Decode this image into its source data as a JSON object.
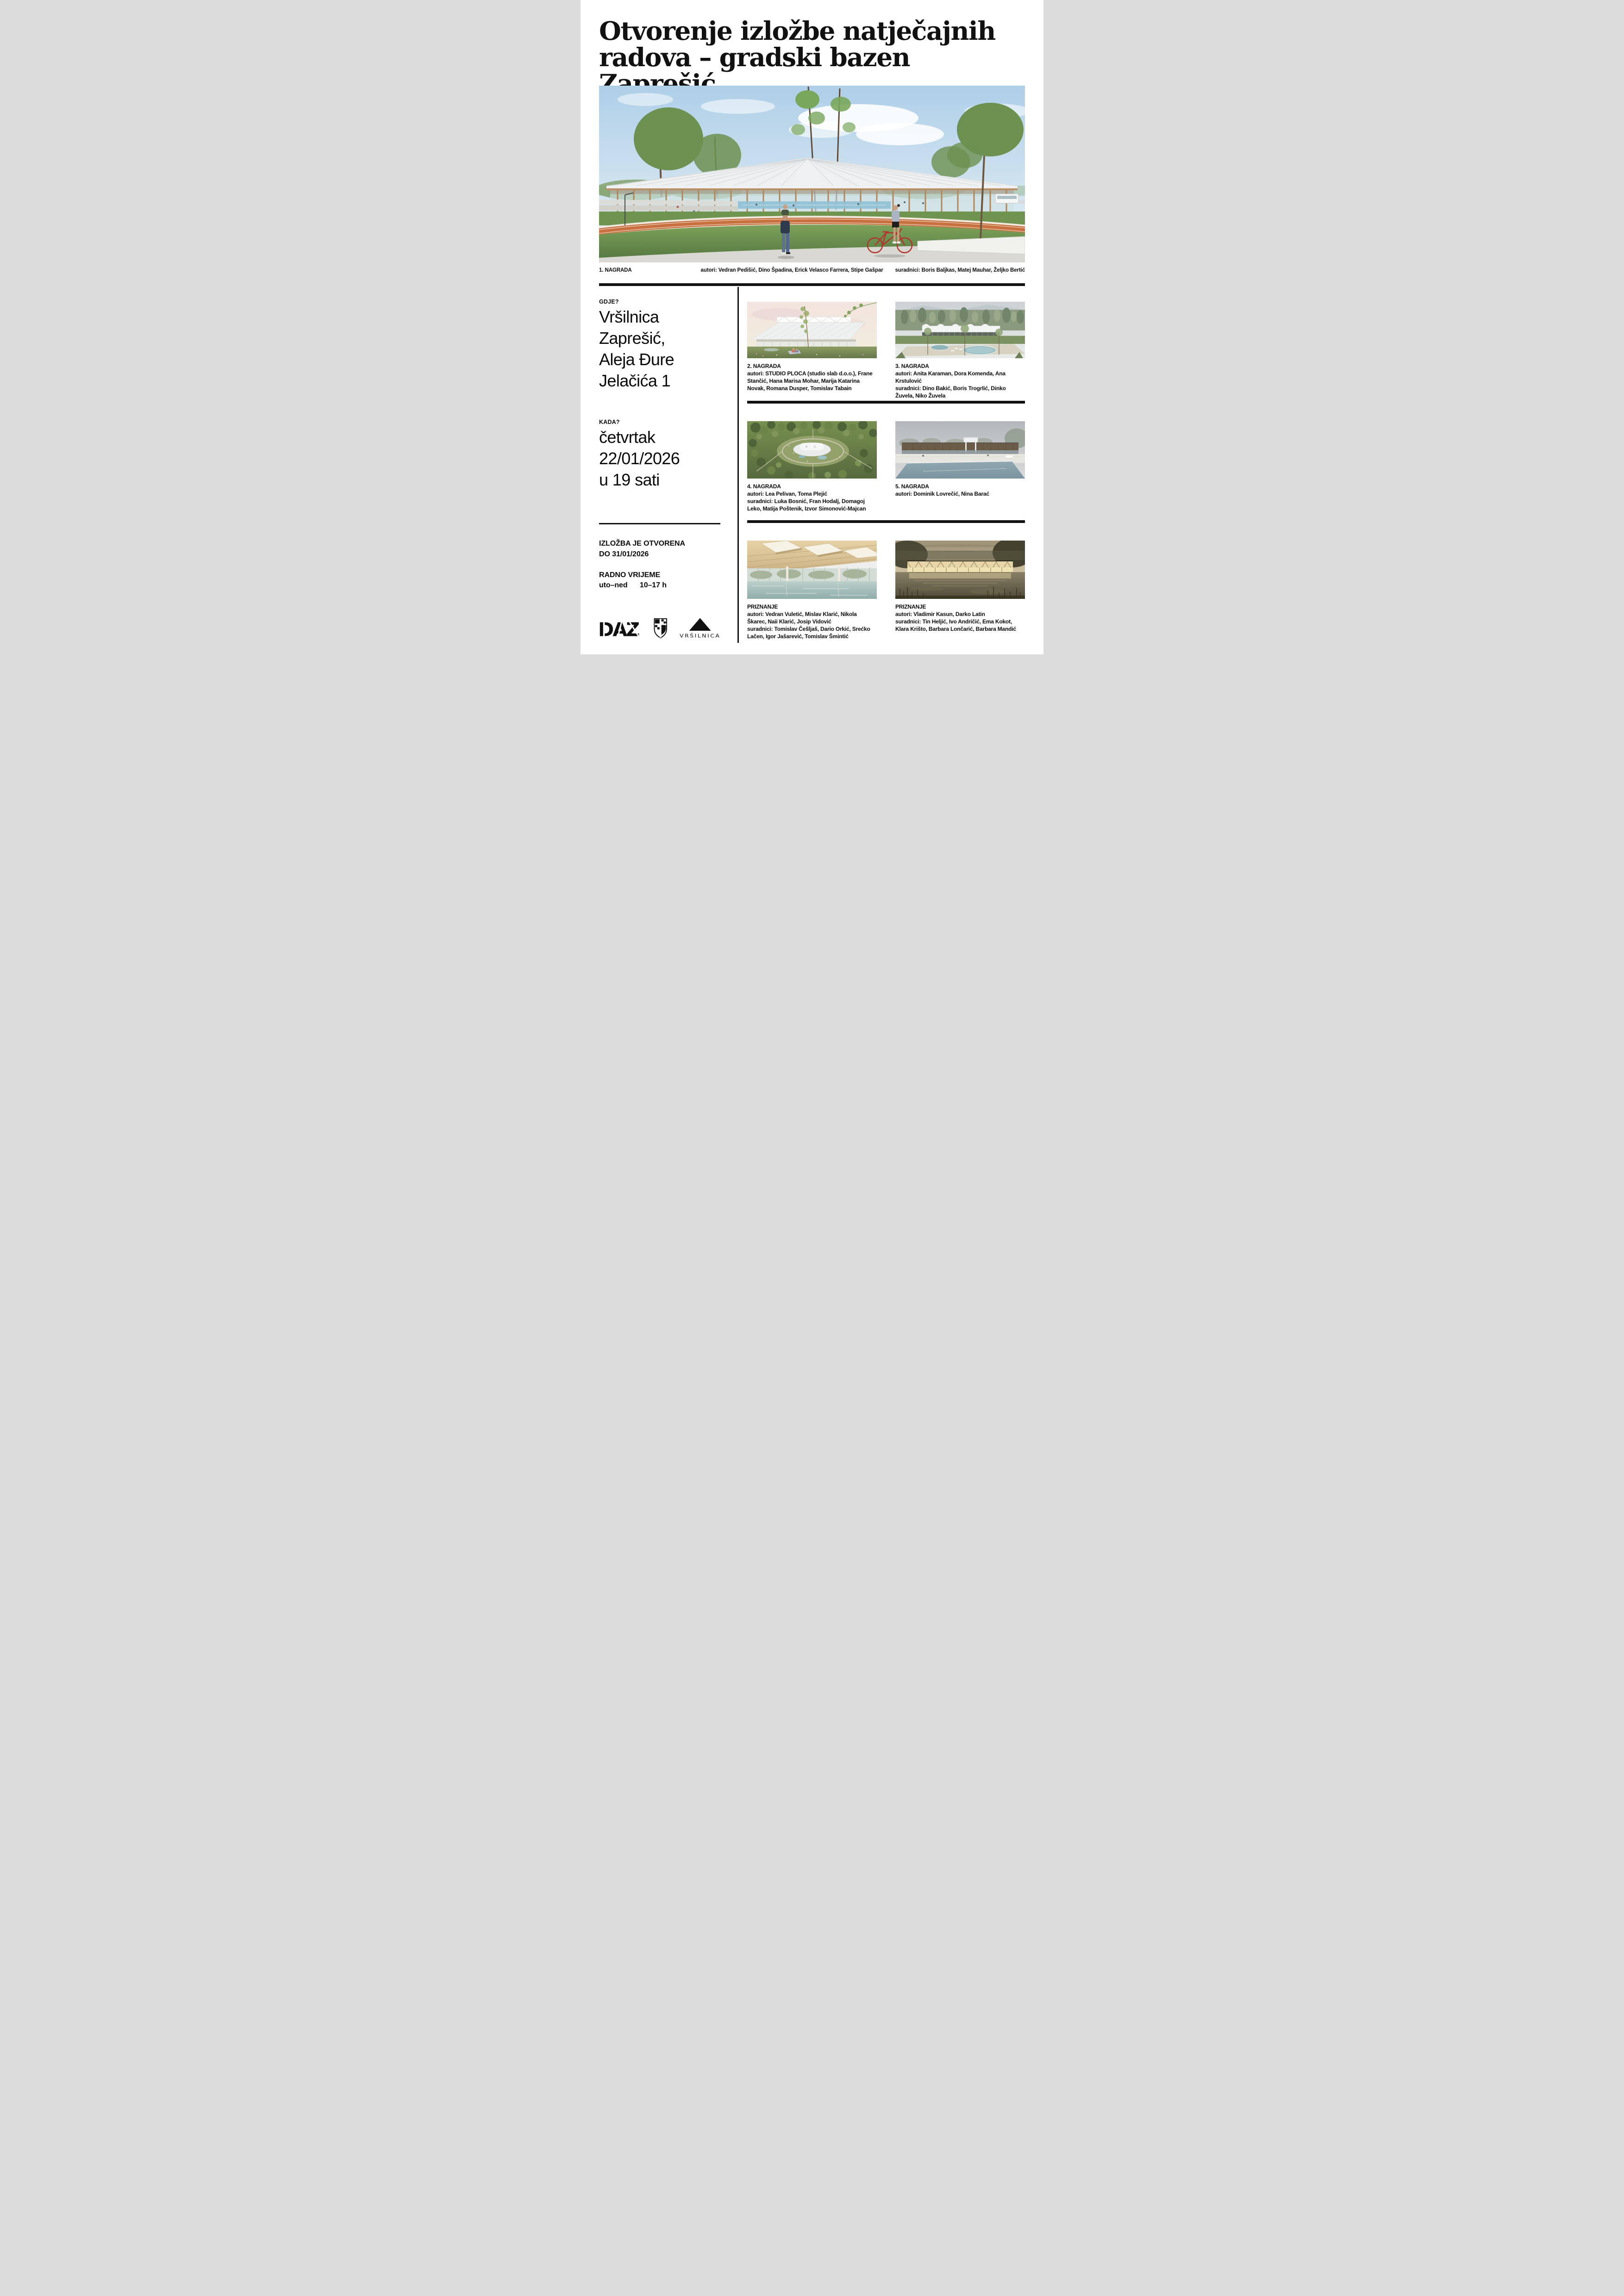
{
  "palette": {
    "ink": "#121212",
    "paper": "#ffffff",
    "track_orange": "#c8713f",
    "bicycle_red": "#b3342a",
    "grass_green": "#6f9450",
    "sky_blue": "#aecfe8",
    "roof_grey": "#eef0f1"
  },
  "title": {
    "line1": "Otvorenje izložbe natječajnih",
    "line2": "radova – gradski bazen Zaprešić"
  },
  "hero": {
    "award": "1. NAGRADA",
    "authors": "autori: Vedran Pedišić, Dino Špadina, Erick Velasco Farrera, Stipe Gašpar",
    "collaborators": "suradnici: Boris Baljkas, Matej Mauhar, Željko Bertić"
  },
  "where": {
    "label": "GDJE?",
    "lines": [
      "Vršilnica",
      "Zaprešić,",
      "Aleja Đure",
      "Jelačića 1"
    ]
  },
  "when": {
    "label": "KADA?",
    "lines": [
      "četvrtak",
      "22/01/2026",
      "u 19 sati"
    ]
  },
  "open": {
    "line1": "IZLOŽBA JE OTVORENA",
    "line2": "DO 31/01/2026"
  },
  "hours": {
    "label": "RADNO VRIJEME",
    "days": "uto–ned",
    "time": "10–17 h"
  },
  "logos": {
    "daz": "DAZ",
    "vrsilnica": "VRŠILNICA"
  },
  "entries": [
    {
      "award": "2. NAGRADA",
      "authors": "autori: STUDIO PLOCA (studio slab d.o.o.), Frane Stančić, Hana Marisa Mohar, Marija Katarina Novak, Romana Dusper, Tomislav Tabain",
      "collaborators": ""
    },
    {
      "award": "3. NAGRADA",
      "authors": "autori: Anita Karaman, Dora Komenda, Ana Krstulović",
      "collaborators": "suradnici: Dino Bakić, Boris Trogrlić, Dinko Žuvela, Niko Žuvela"
    },
    {
      "award": "4. NAGRADA",
      "authors": "autori: Lea Pelivan, Toma Plejić",
      "collaborators": "suradnici: Luka Bosnić, Fran Hodalj, Domagoj Leko, Matija Poštenik, Izvor Simonović-Majcan"
    },
    {
      "award": "5. NAGRADA",
      "authors": "autori: Dominik Lovrečić, Nina Barać",
      "collaborators": ""
    },
    {
      "award": "PRIZNANJE",
      "authors": "autori: Vedran Vuletić, Mislav Klarić, Nikola Škarec, Naii Klarić, Josip Vidović",
      "collaborators": "suradnici: Tomislav Češljaš, Dario Orkić, Srećko Lačen, Igor Jašarević, Tomislav Šmintić"
    },
    {
      "award": "PRIZNANJE",
      "authors": "autori: Vladimir Kasun, Darko Latin",
      "collaborators": "suradnici: Tin Heljić, Ivo Andričić, Ema Kokot, Klara Krišto, Barbara Lončarić, Barbara Mandić"
    }
  ]
}
